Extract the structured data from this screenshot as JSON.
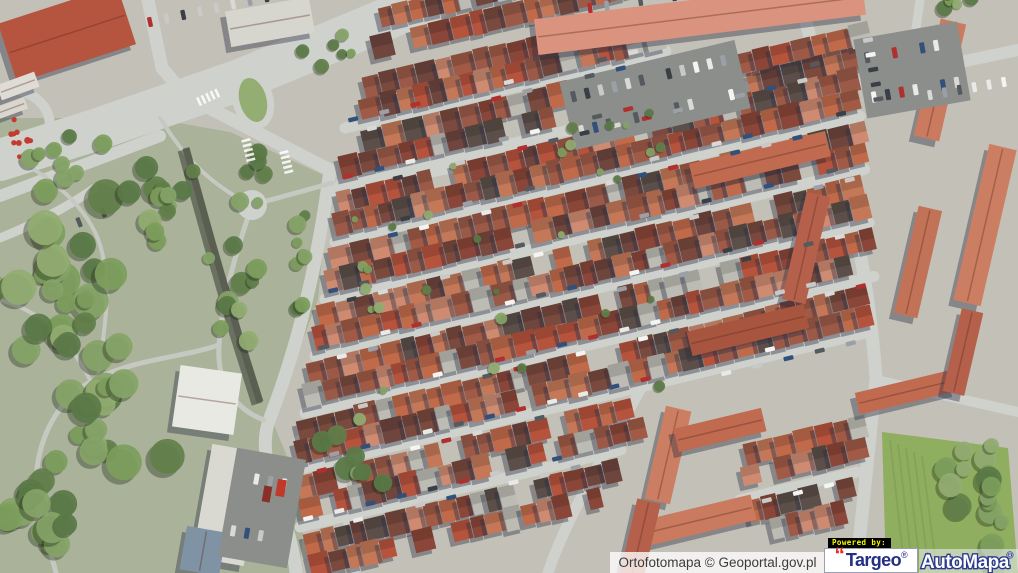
{
  "attribution": {
    "label": "Ortofotomapa © Geoportal.gov.pl",
    "text_color": "#3c3c3c",
    "bg_color": "rgba(255,255,255,0.78)"
  },
  "branding": {
    "powered_by": "Powered by:",
    "powered_bg": "#000000",
    "powered_text_color": "#f8fc00",
    "targeo_quote": "“",
    "targeo_name": "Targeo",
    "targeo_reg": "®",
    "targeo_navy": "#242f85",
    "targeo_red": "#e0301e",
    "targeo_bg": "#ffffff",
    "automapa_name": "AutoMapa",
    "automapa_reg": "®",
    "automapa_fill": "#ffffff",
    "automapa_outline": "#2b3a8f",
    "automapa_bg": "rgba(238,241,247,0.55)"
  },
  "scene": {
    "w": 1018,
    "h": 573,
    "angle": -13.5,
    "colors": {
      "base": "#c3c1b7",
      "park": "#aab299",
      "road": "#ced1cc",
      "path": "#c6c9c2",
      "shadow": "rgba(42,46,68,0.40)",
      "wall": "#5a5f52",
      "lot": "#8b8e8b",
      "field": "#8fae5f",
      "fieldLine": "#7d9c4e",
      "flower": "#c23b2e"
    },
    "roofPalette": [
      "#b5533c",
      "#c16a4a",
      "#7a4a3e",
      "#5c4f49",
      "#cf8b72",
      "#a05a45",
      "#8a4638",
      "#c47858",
      "#9b5a48",
      "#6e463e"
    ],
    "greenPalette": [
      "#7d9e5c",
      "#93ad72",
      "#627f4a",
      "#86a468",
      "#5a7a46"
    ],
    "carPalette": [
      "#f4f4f2",
      "#e9e9e7",
      "#d9d9d7",
      "#555a60",
      "#3a3f45",
      "#b03030",
      "#33507a",
      "#c9c9c7",
      "#9aa0a6"
    ],
    "parkPoly": [
      [
        0,
        118
      ],
      [
        150,
        118
      ],
      [
        230,
        132
      ],
      [
        330,
        178
      ],
      [
        318,
        300
      ],
      [
        272,
        420
      ],
      [
        305,
        500
      ],
      [
        300,
        573
      ],
      [
        0,
        573
      ]
    ],
    "fieldPoly": [
      [
        882,
        432
      ],
      [
        1008,
        448
      ],
      [
        1018,
        573
      ],
      [
        886,
        573
      ]
    ],
    "roads": [
      {
        "d": "M 432,0 L 240,80 L 95,130 L 0,160",
        "w": 42
      },
      {
        "d": "M 0,196 L 160,136",
        "w": 12
      },
      {
        "d": "M 148,0 L 162,68 L 186,96 L 330,170",
        "w": 13
      },
      {
        "d": "M 330,170 C 318,260 300,340 270,418 C 252,462 290,510 296,573",
        "w": 13
      },
      {
        "d": "M 332,192 L 1018,50",
        "w": 12
      },
      {
        "d": "M 800,0 C 838,140 868,260 876,378 L 856,573",
        "w": 13
      },
      {
        "d": "M 876,380 L 1018,412",
        "w": 10
      },
      {
        "d": "M 8,88 C 58,94 64,142 22,168",
        "w": 10
      },
      {
        "d": "M 0,238 C 40,222 70,205 95,188",
        "w": 9
      },
      {
        "d": "M 298,440 L 340,470 L 355,573",
        "w": 9
      },
      {
        "d": "M 920,0 L 912,56 L 940,120",
        "w": 9
      },
      {
        "d": "M 648,375 C 605,455 565,520 548,573",
        "w": 11
      },
      {
        "d": "M 700,55 L 655,250",
        "w": 9
      }
    ],
    "paths": [
      {
        "d": "M 252,205 L 332,183",
        "w": 5
      },
      {
        "d": "M 252,205 C 235,255 222,300 219,345 C 216,390 242,412 264,420",
        "w": 5
      },
      {
        "d": "M 219,345 C 180,358 140,358 98,378 C 62,394 42,430 37,468 C 32,505 48,540 56,573",
        "w": 5
      },
      {
        "d": "M 98,378 C 104,330 112,292 102,252 C 94,216 60,182 20,162",
        "w": 4
      },
      {
        "d": "M 0,300 C 40,310 70,340 90,380",
        "w": 4
      },
      {
        "d": "M 160,118 C 180,150 200,175 235,196",
        "w": 4
      }
    ],
    "streets": [
      {
        "x": 345,
        "y": 128,
        "len": 330
      },
      {
        "x": 340,
        "y": 185,
        "len": 530
      },
      {
        "x": 335,
        "y": 242,
        "len": 540
      },
      {
        "x": 325,
        "y": 299,
        "len": 555
      },
      {
        "x": 315,
        "y": 356,
        "len": 570
      },
      {
        "x": 305,
        "y": 413,
        "len": 585
      },
      {
        "x": 295,
        "y": 470,
        "len": 585
      },
      {
        "x": 300,
        "y": 527,
        "len": 330
      },
      {
        "x": 740,
        "y": 500,
        "len": 120
      }
    ],
    "houseRows": [
      {
        "x": 380,
        "y": 18,
        "len": 260
      },
      {
        "x": 372,
        "y": 48,
        "len": 280
      },
      {
        "x": 364,
        "y": 88,
        "len": 300
      },
      {
        "x": 360,
        "y": 110,
        "len": 310
      },
      {
        "x": 344,
        "y": 146,
        "len": 350
      },
      {
        "x": 340,
        "y": 168,
        "len": 360
      },
      {
        "x": 690,
        "y": 98,
        "len": 175
      },
      {
        "x": 698,
        "y": 74,
        "len": 165
      },
      {
        "x": 338,
        "y": 203,
        "len": 530
      },
      {
        "x": 334,
        "y": 225,
        "len": 535
      },
      {
        "x": 330,
        "y": 260,
        "len": 545
      },
      {
        "x": 326,
        "y": 282,
        "len": 550
      },
      {
        "x": 318,
        "y": 317,
        "len": 560
      },
      {
        "x": 314,
        "y": 339,
        "len": 565
      },
      {
        "x": 308,
        "y": 374,
        "len": 575
      },
      {
        "x": 304,
        "y": 396,
        "len": 580
      },
      {
        "x": 298,
        "y": 431,
        "len": 585
      },
      {
        "x": 296,
        "y": 453,
        "len": 585
      },
      {
        "x": 298,
        "y": 488,
        "len": 340
      },
      {
        "x": 300,
        "y": 510,
        "len": 340
      },
      {
        "x": 305,
        "y": 545,
        "len": 320
      },
      {
        "x": 310,
        "y": 567,
        "len": 300
      },
      {
        "x": 745,
        "y": 455,
        "len": 115
      },
      {
        "x": 742,
        "y": 477,
        "len": 115
      },
      {
        "x": 748,
        "y": 512,
        "len": 100
      },
      {
        "x": 752,
        "y": 534,
        "len": 95
      }
    ],
    "bigBuildings": [
      {
        "x": 700,
        "y": 17,
        "w": 330,
        "h": 36,
        "rot": -7,
        "fill": "#d9937f"
      },
      {
        "x": 67,
        "y": 34,
        "w": 125,
        "h": 62,
        "rot": -18,
        "fill": "#b5543f"
      },
      {
        "x": 270,
        "y": 22,
        "w": 85,
        "h": 36,
        "rot": -10,
        "fill": "#d6d6ce"
      },
      {
        "x": 18,
        "y": 86,
        "w": 40,
        "h": 16,
        "rot": -20,
        "fill": "#dedcd4"
      },
      {
        "x": 12,
        "y": 108,
        "w": 30,
        "h": 12,
        "rot": -20,
        "fill": "#d8d6ce"
      },
      {
        "x": 207,
        "y": 400,
        "w": 62,
        "h": 62,
        "rot": 8,
        "fill": "#e9e9e3"
      },
      {
        "x": 228,
        "y": 505,
        "w": 52,
        "h": 115,
        "rot": 10,
        "fill": "#d9d9d2"
      },
      {
        "x": 203,
        "y": 551,
        "w": 40,
        "h": 44,
        "rot": 10,
        "fill": "#7f93a4"
      },
      {
        "x": 940,
        "y": 80,
        "w": 26,
        "h": 120,
        "rot": 13,
        "fill": "#c97a5f"
      },
      {
        "x": 985,
        "y": 225,
        "w": 28,
        "h": 160,
        "rot": 13,
        "fill": "#cc7e62"
      },
      {
        "x": 918,
        "y": 262,
        "w": 24,
        "h": 110,
        "rot": 13,
        "fill": "#c27257"
      },
      {
        "x": 760,
        "y": 160,
        "w": 140,
        "h": 26,
        "rot": -13.5,
        "fill": "#c06a50"
      },
      {
        "x": 806,
        "y": 248,
        "w": 24,
        "h": 110,
        "rot": 13,
        "fill": "#b5604a"
      },
      {
        "x": 748,
        "y": 330,
        "w": 120,
        "h": 25,
        "rot": -13.5,
        "fill": "#a8553f"
      },
      {
        "x": 906,
        "y": 392,
        "w": 100,
        "h": 22,
        "rot": -13.5,
        "fill": "#c06a50"
      },
      {
        "x": 963,
        "y": 352,
        "w": 22,
        "h": 85,
        "rot": 13,
        "fill": "#b5604a"
      },
      {
        "x": 668,
        "y": 455,
        "w": 26,
        "h": 95,
        "rot": 13,
        "fill": "#cc7e62"
      },
      {
        "x": 700,
        "y": 520,
        "w": 110,
        "h": 26,
        "rot": -13.5,
        "fill": "#c97a5f"
      },
      {
        "x": 640,
        "y": 540,
        "w": 24,
        "h": 80,
        "rot": 13,
        "fill": "#b5604a"
      },
      {
        "x": 720,
        "y": 430,
        "w": 90,
        "h": 24,
        "rot": -13.5,
        "fill": "#c06a50"
      }
    ],
    "lots": [
      {
        "x": 655,
        "y": 95,
        "w": 180,
        "h": 70,
        "rot": -13.5
      },
      {
        "x": 912,
        "y": 70,
        "w": 105,
        "h": 80,
        "rot": -10
      },
      {
        "x": 262,
        "y": 508,
        "w": 70,
        "h": 110,
        "rot": 10
      }
    ],
    "treeClusters": [
      {
        "x": 60,
        "y": 260,
        "rx": 110,
        "ry": 100,
        "n": 26,
        "rmin": 8,
        "rmax": 18
      },
      {
        "x": 95,
        "y": 410,
        "rx": 85,
        "ry": 105,
        "n": 22,
        "rmin": 8,
        "rmax": 18
      },
      {
        "x": 45,
        "y": 520,
        "rx": 70,
        "ry": 55,
        "n": 14,
        "rmin": 8,
        "rmax": 16
      },
      {
        "x": 150,
        "y": 205,
        "rx": 55,
        "ry": 50,
        "n": 12,
        "rmin": 6,
        "rmax": 14
      },
      {
        "x": 235,
        "y": 310,
        "rx": 35,
        "ry": 75,
        "n": 10,
        "rmin": 6,
        "rmax": 12
      },
      {
        "x": 300,
        "y": 260,
        "rx": 14,
        "ry": 60,
        "n": 8,
        "rmin": 5,
        "rmax": 9
      },
      {
        "x": 70,
        "y": 155,
        "rx": 55,
        "ry": 28,
        "n": 8,
        "rmin": 5,
        "rmax": 10
      },
      {
        "x": 330,
        "y": 60,
        "rx": 40,
        "ry": 30,
        "n": 6,
        "rmin": 4,
        "rmax": 8
      },
      {
        "x": 500,
        "y": 300,
        "rx": 210,
        "ry": 150,
        "n": 20,
        "rmin": 3,
        "rmax": 6
      },
      {
        "x": 600,
        "y": 140,
        "rx": 150,
        "ry": 60,
        "n": 10,
        "rmin": 3,
        "rmax": 6
      },
      {
        "x": 985,
        "y": 505,
        "rx": 45,
        "ry": 75,
        "n": 16,
        "rmin": 7,
        "rmax": 14
      },
      {
        "x": 350,
        "y": 460,
        "rx": 40,
        "ry": 60,
        "n": 8,
        "rmin": 6,
        "rmax": 12
      },
      {
        "x": 255,
        "y": 180,
        "rx": 30,
        "ry": 40,
        "n": 6,
        "rmin": 5,
        "rmax": 10
      },
      {
        "x": 960,
        "y": 10,
        "rx": 40,
        "ry": 18,
        "n": 5,
        "rmin": 5,
        "rmax": 9
      }
    ],
    "carRowsExtra": [
      {
        "x": 150,
        "y": 22,
        "a": -12,
        "n": 9,
        "sp": 17
      },
      {
        "x": 55,
        "y": 232,
        "a": -22,
        "n": 3,
        "sp": 26
      },
      {
        "x": 590,
        "y": 8,
        "a": -8,
        "n": 10,
        "sp": 17
      },
      {
        "x": 868,
        "y": 40,
        "a": 80,
        "n": 5,
        "sp": 15
      },
      {
        "x": 930,
        "y": 95,
        "a": -10,
        "n": 6,
        "sp": 15
      }
    ],
    "flowers": {
      "x": 20,
      "y": 135,
      "rx": 14,
      "ry": 22,
      "n": 9
    },
    "wall": {
      "d": "M 186,148 L 212,242 L 238,332 L 260,402",
      "w": 7
    },
    "teardrop": {
      "x": 253,
      "y": 100,
      "rx": 17,
      "ry": 26,
      "rot": -15
    },
    "plaza": {
      "x": 252,
      "y": 205,
      "r": 15
    },
    "truck": {
      "x": 281,
      "y": 488,
      "w": 9,
      "h": 17,
      "rot": 10,
      "fill": "#c0392b"
    }
  }
}
